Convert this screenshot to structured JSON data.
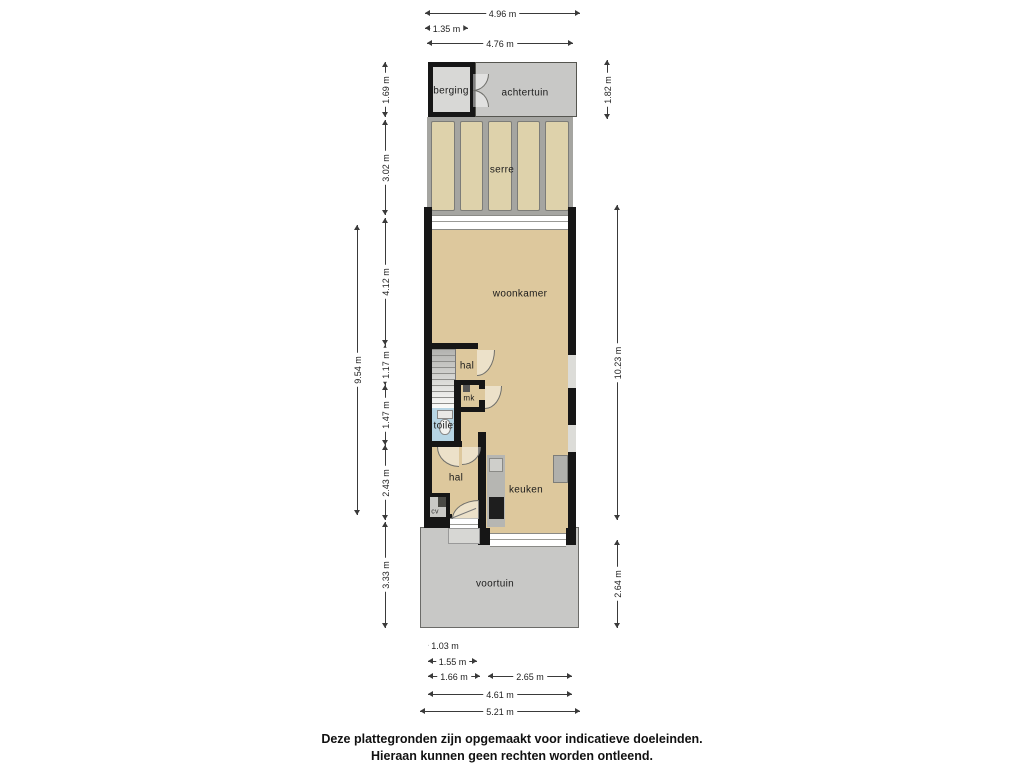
{
  "floorplan": {
    "rooms": {
      "berging": "berging",
      "achtertuin": "achtertuin",
      "serre": "serre",
      "woonkamer": "woonkamer",
      "hal_upper": "hal",
      "mk": "mk",
      "toilet": "toilet",
      "hal_lower": "hal",
      "cv": "cv",
      "keuken": "keuken",
      "voortuin": "voortuin"
    },
    "dims": {
      "top": [
        "4.96 m",
        "1.35 m",
        "4.76 m"
      ],
      "left": [
        "1.69 m",
        "3.02 m",
        "4.12 m",
        "1.17 m",
        "1.47 m",
        "2.43 m",
        "3.33 m",
        "9.54 m"
      ],
      "right": [
        "1.82 m",
        "10.23 m",
        "2.64 m"
      ],
      "bottom": [
        "1.03 m",
        "1.55 m",
        "1.66 m",
        "2.65 m",
        "4.61 m",
        "5.21 m"
      ]
    },
    "colors": {
      "wall": "#161616",
      "floor": "#ddc89d",
      "serre_panel": "#ded2ab",
      "serre_frame": "#a5a5a1",
      "garden": "#c8c8c6",
      "berging_fill": "#d8d8d6",
      "toilet_floor": "#b7d5e4",
      "counter": "#b6b6b2",
      "appliance_dark": "#1e1e1e",
      "dim_line": "#3a3a3a"
    }
  },
  "footer": {
    "line1": "Deze plattegronden zijn opgemaakt voor indicatieve doeleinden.",
    "line2": "Hieraan kunnen geen rechten worden ontleend."
  }
}
